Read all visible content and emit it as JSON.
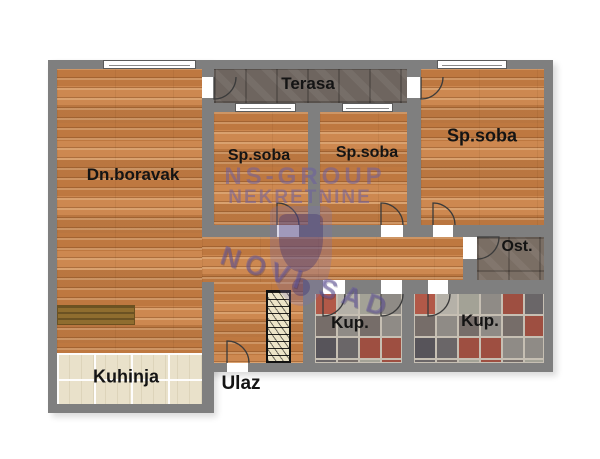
{
  "rooms": {
    "living": {
      "label": "Dn.boravak"
    },
    "terrace": {
      "label": "Terasa"
    },
    "bedroom_left": {
      "label": "Sp.soba"
    },
    "bedroom_middle": {
      "label": "Sp.soba"
    },
    "bedroom_right": {
      "label": "Sp.soba"
    },
    "storage": {
      "label": "Ost."
    },
    "bathroom_middle": {
      "label": "Kup."
    },
    "bathroom_right": {
      "label": "Kup."
    },
    "kitchen": {
      "label": "Kuhinja"
    },
    "entrance": {
      "label": "Ulaz"
    }
  },
  "watermark": {
    "line1": "NS-GROUP",
    "line2": "NEKRETNINE",
    "city": "NOVI SAD"
  },
  "colors": {
    "wall": "#7f7f7f",
    "wood_floor": "#c9854d",
    "dark_tile": "#6e655f",
    "kitchen_tile": "#e9e1ca",
    "label_text": "#141414",
    "watermark": "#6c5ea0",
    "bath_palette": [
      "#b25948",
      "#8f8b86",
      "#57545a",
      "#b5b1a8",
      "#9e4f41",
      "#766d69",
      "#a3a296",
      "#6a6668"
    ]
  }
}
